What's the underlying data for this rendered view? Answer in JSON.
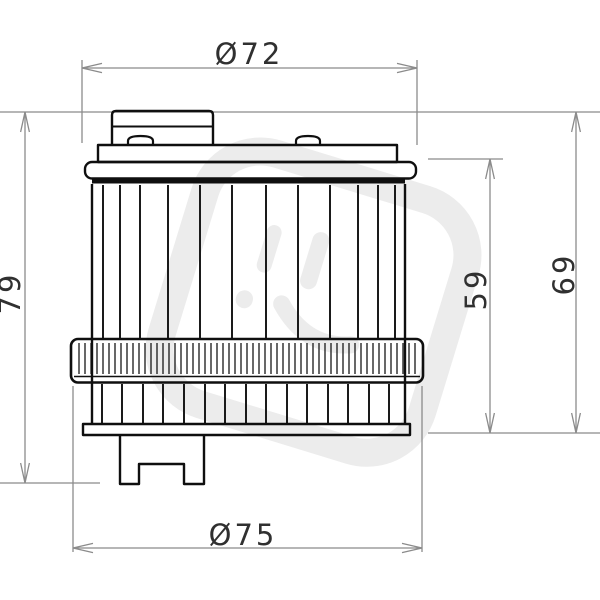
{
  "drawing": {
    "type": "technical-drawing",
    "part": "oil-filter-side-view",
    "colors": {
      "outline": "#0f0f0f",
      "dimension_lines": "#8b8b8b",
      "dimension_text": "#303030",
      "watermark": "#ececec"
    },
    "dimensions": {
      "top_diameter": {
        "label": "Ø72"
      },
      "bottom_diameter": {
        "label": "Ø75"
      },
      "overall_height": {
        "label": "79"
      },
      "body_height": {
        "label": "59"
      },
      "case_height": {
        "label": "69"
      }
    }
  }
}
